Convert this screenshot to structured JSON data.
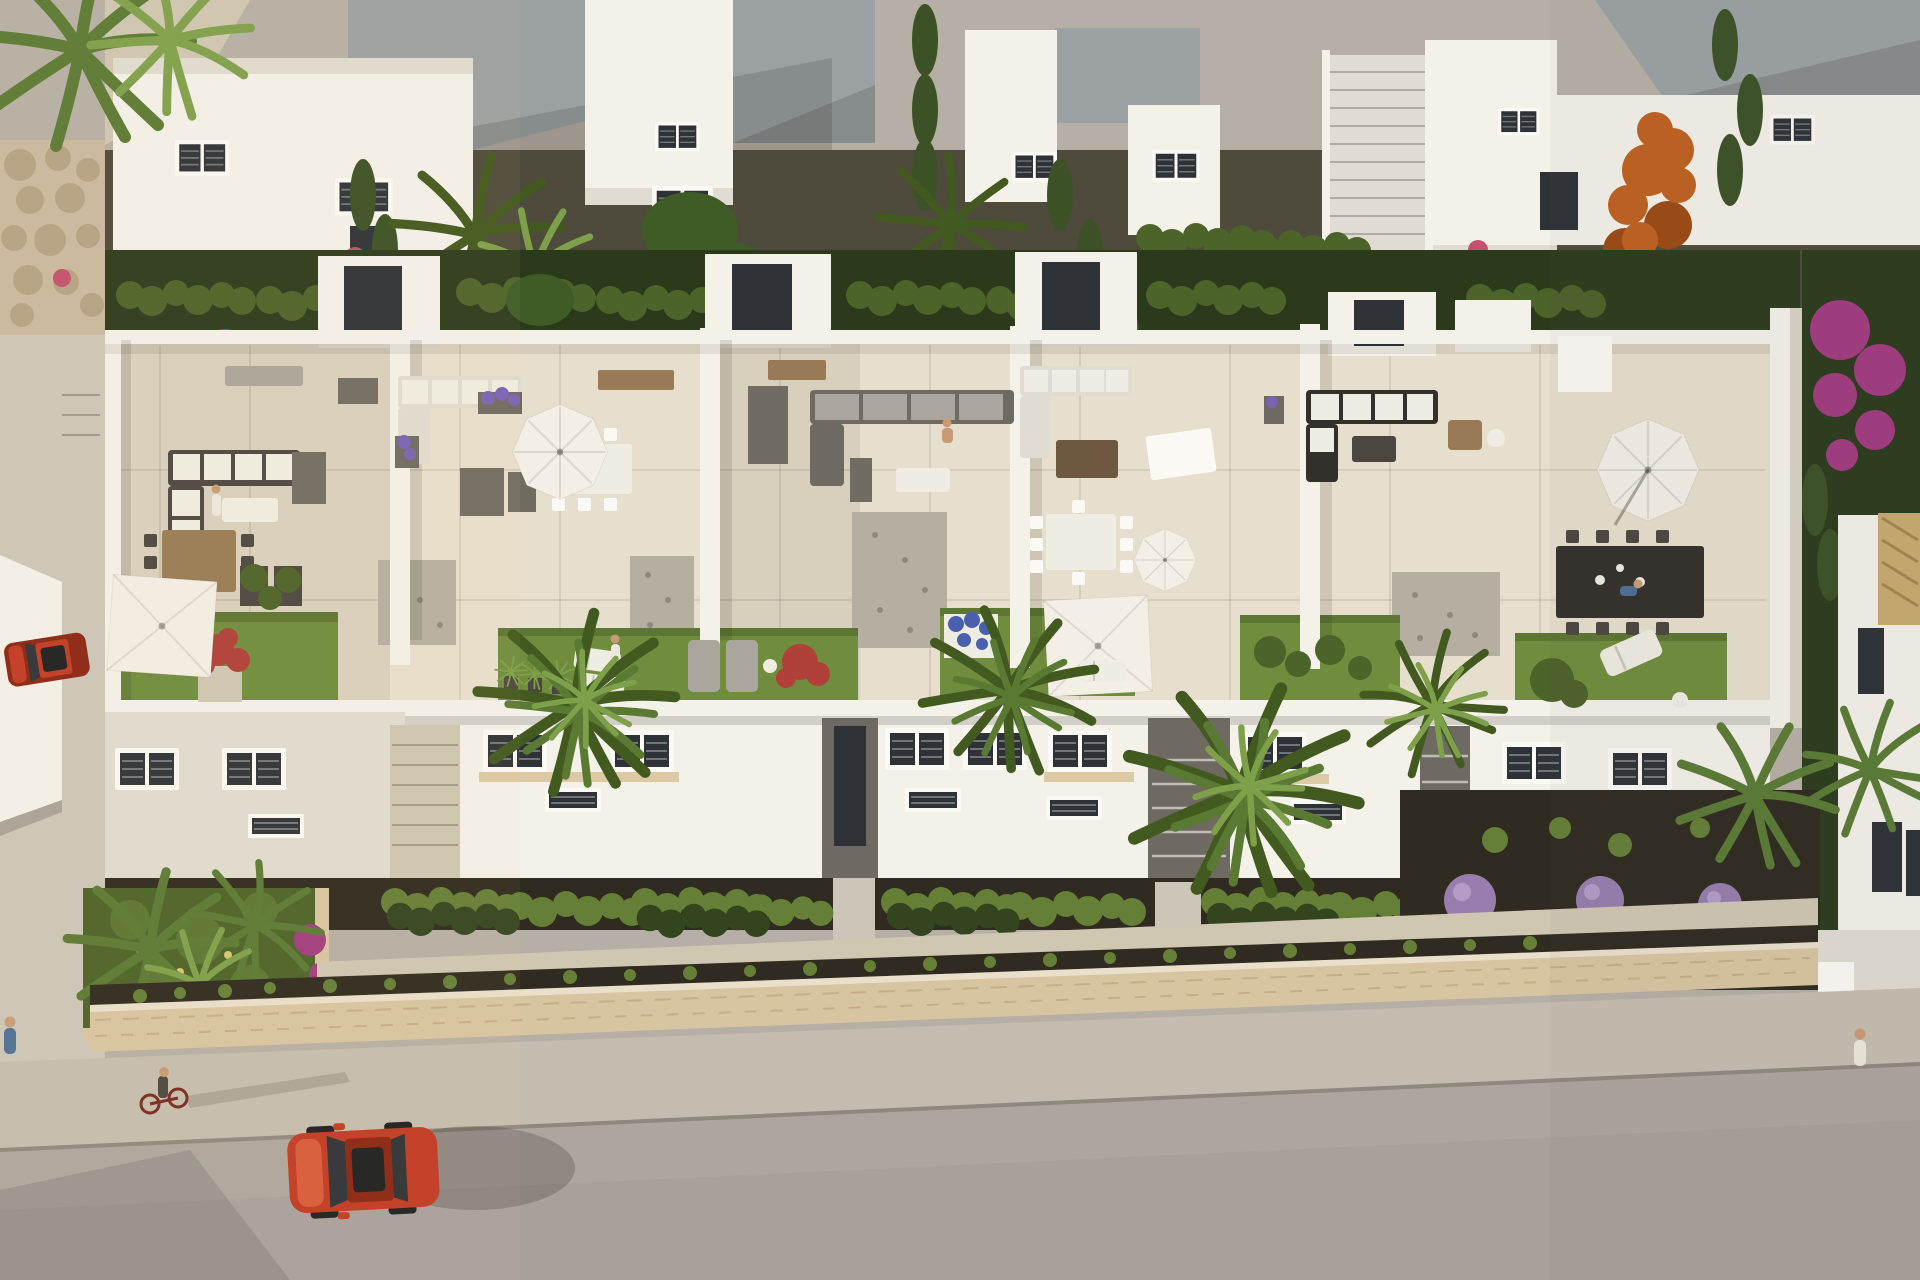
{
  "scene": {
    "image_type": "aerial 3D architectural rendering",
    "subject": "row of white modern townhouses with furnished roof terraces and lawns",
    "foreground": "stone boundary wall, sidewalk and asphalt street",
    "background": "second row of white villas with grey flat roofs, hedges and trees",
    "lighting": "low warm sun from the left casting long shadows",
    "people_count": 7,
    "vehicle_count": 3,
    "vehicles": [
      "red hatchback driving on street",
      "small red car parked in left driveway",
      "red bicycle with rider"
    ],
    "parasols": [
      "square white umbrella on left lawn",
      "square white umbrella on middle lawn",
      "round parasol over white dining table",
      "small round parasol middle-right",
      "large round cantilever parasol right terrace"
    ],
    "terrace_items": [
      "lounge sofas with white cushions",
      "wooden dining table",
      "white dining tables",
      "black dining table",
      "grey storage boxes",
      "pebble patches",
      "sun loungers",
      "planters with lavender, blue, red and magenta flowers"
    ],
    "vegetation": [
      "fan palms",
      "banana plants",
      "cypress hedges",
      "boxwood hedge rows",
      "orange autumn tree",
      "magenta bougainvillea",
      "round lilac shrubs",
      "rooftop lawns"
    ]
  },
  "colors": {
    "page_bg": "#b6afa5",
    "sun_tint": "#ffdf9e",
    "shade_tint": "#5d6268",
    "road": "#a8a19a",
    "sidewalk": "#c4bdaf",
    "curb": "#8f887e",
    "driveway": "#ccc6b8",
    "path_beige": "#cfc7b2",
    "stone_wall": "#d7c5a1",
    "stone_line": "#b89f78",
    "soil_dark": "#2f2b20",
    "gravel_top": "#4e4a3c",
    "boulder_wall": "#c9b99d",
    "boulder_stone": "#b5a385",
    "white_wall": "#f4f1e9",
    "white_bright": "#fbf9f4",
    "white_shade": "#e0dcd1",
    "wall_side": "#d7d2c5",
    "roof_gravel": "#9ba1a3",
    "roof_gravel_dark": "#878e91",
    "terrace_floor": "#e7dfcd",
    "terrace_floor_shade": "#d8d0bd",
    "pebble": "#b5afa2",
    "pebble_dot": "#8e897c",
    "lawn": "#6f8d3d",
    "lawn_dark": "#5c7733",
    "hedge_bright": "#657f36",
    "hedge_mid": "#4c6329",
    "hedge_dark": "#33451f",
    "leaf_dark": "#2c3a1c",
    "palm_green": "#5a7a34",
    "palm_light": "#7fa04b",
    "palm_deep": "#42591f",
    "banana_green": "#3f5c26",
    "cypress": "#3c5226",
    "tree_orange": "#c06020",
    "tree_orange_dark": "#9c4a14",
    "bougainvillea": "#a23b80",
    "pink_plant": "#c4506e",
    "flower_lavender": "#7b63b4",
    "flower_blue": "#4a5fae",
    "flower_red": "#b04038",
    "lilac_bush": "#977eae",
    "lilac_light": "#b49cc6",
    "yellow_flower": "#d8c36a",
    "furn_frame_dark": "#4b4740",
    "furn_gray": "#6e6a61",
    "furn_box": "#716c62",
    "cushion_white": "#efece1",
    "cushion_gray": "#aaa69b",
    "wood": "#987b55",
    "wood_dark": "#6e5840",
    "table_black": "#33302c",
    "umbrella": "#f3efe5",
    "car_red": "#c13a24",
    "car_red_light": "#d85b3c",
    "car_red_dark": "#8c2513",
    "glass_dark": "#2e3236",
    "glass_black": "#1d1f21",
    "gate_dark": "#3a3733",
    "tile_roof": "#c9a96f",
    "tile_roof_line": "#a5854f",
    "window_slat": "#70757a",
    "skin": "#c89b76",
    "shirt_blue": "#4d6f94",
    "shirt_white": "#ece8dd",
    "ink": "#000000"
  }
}
